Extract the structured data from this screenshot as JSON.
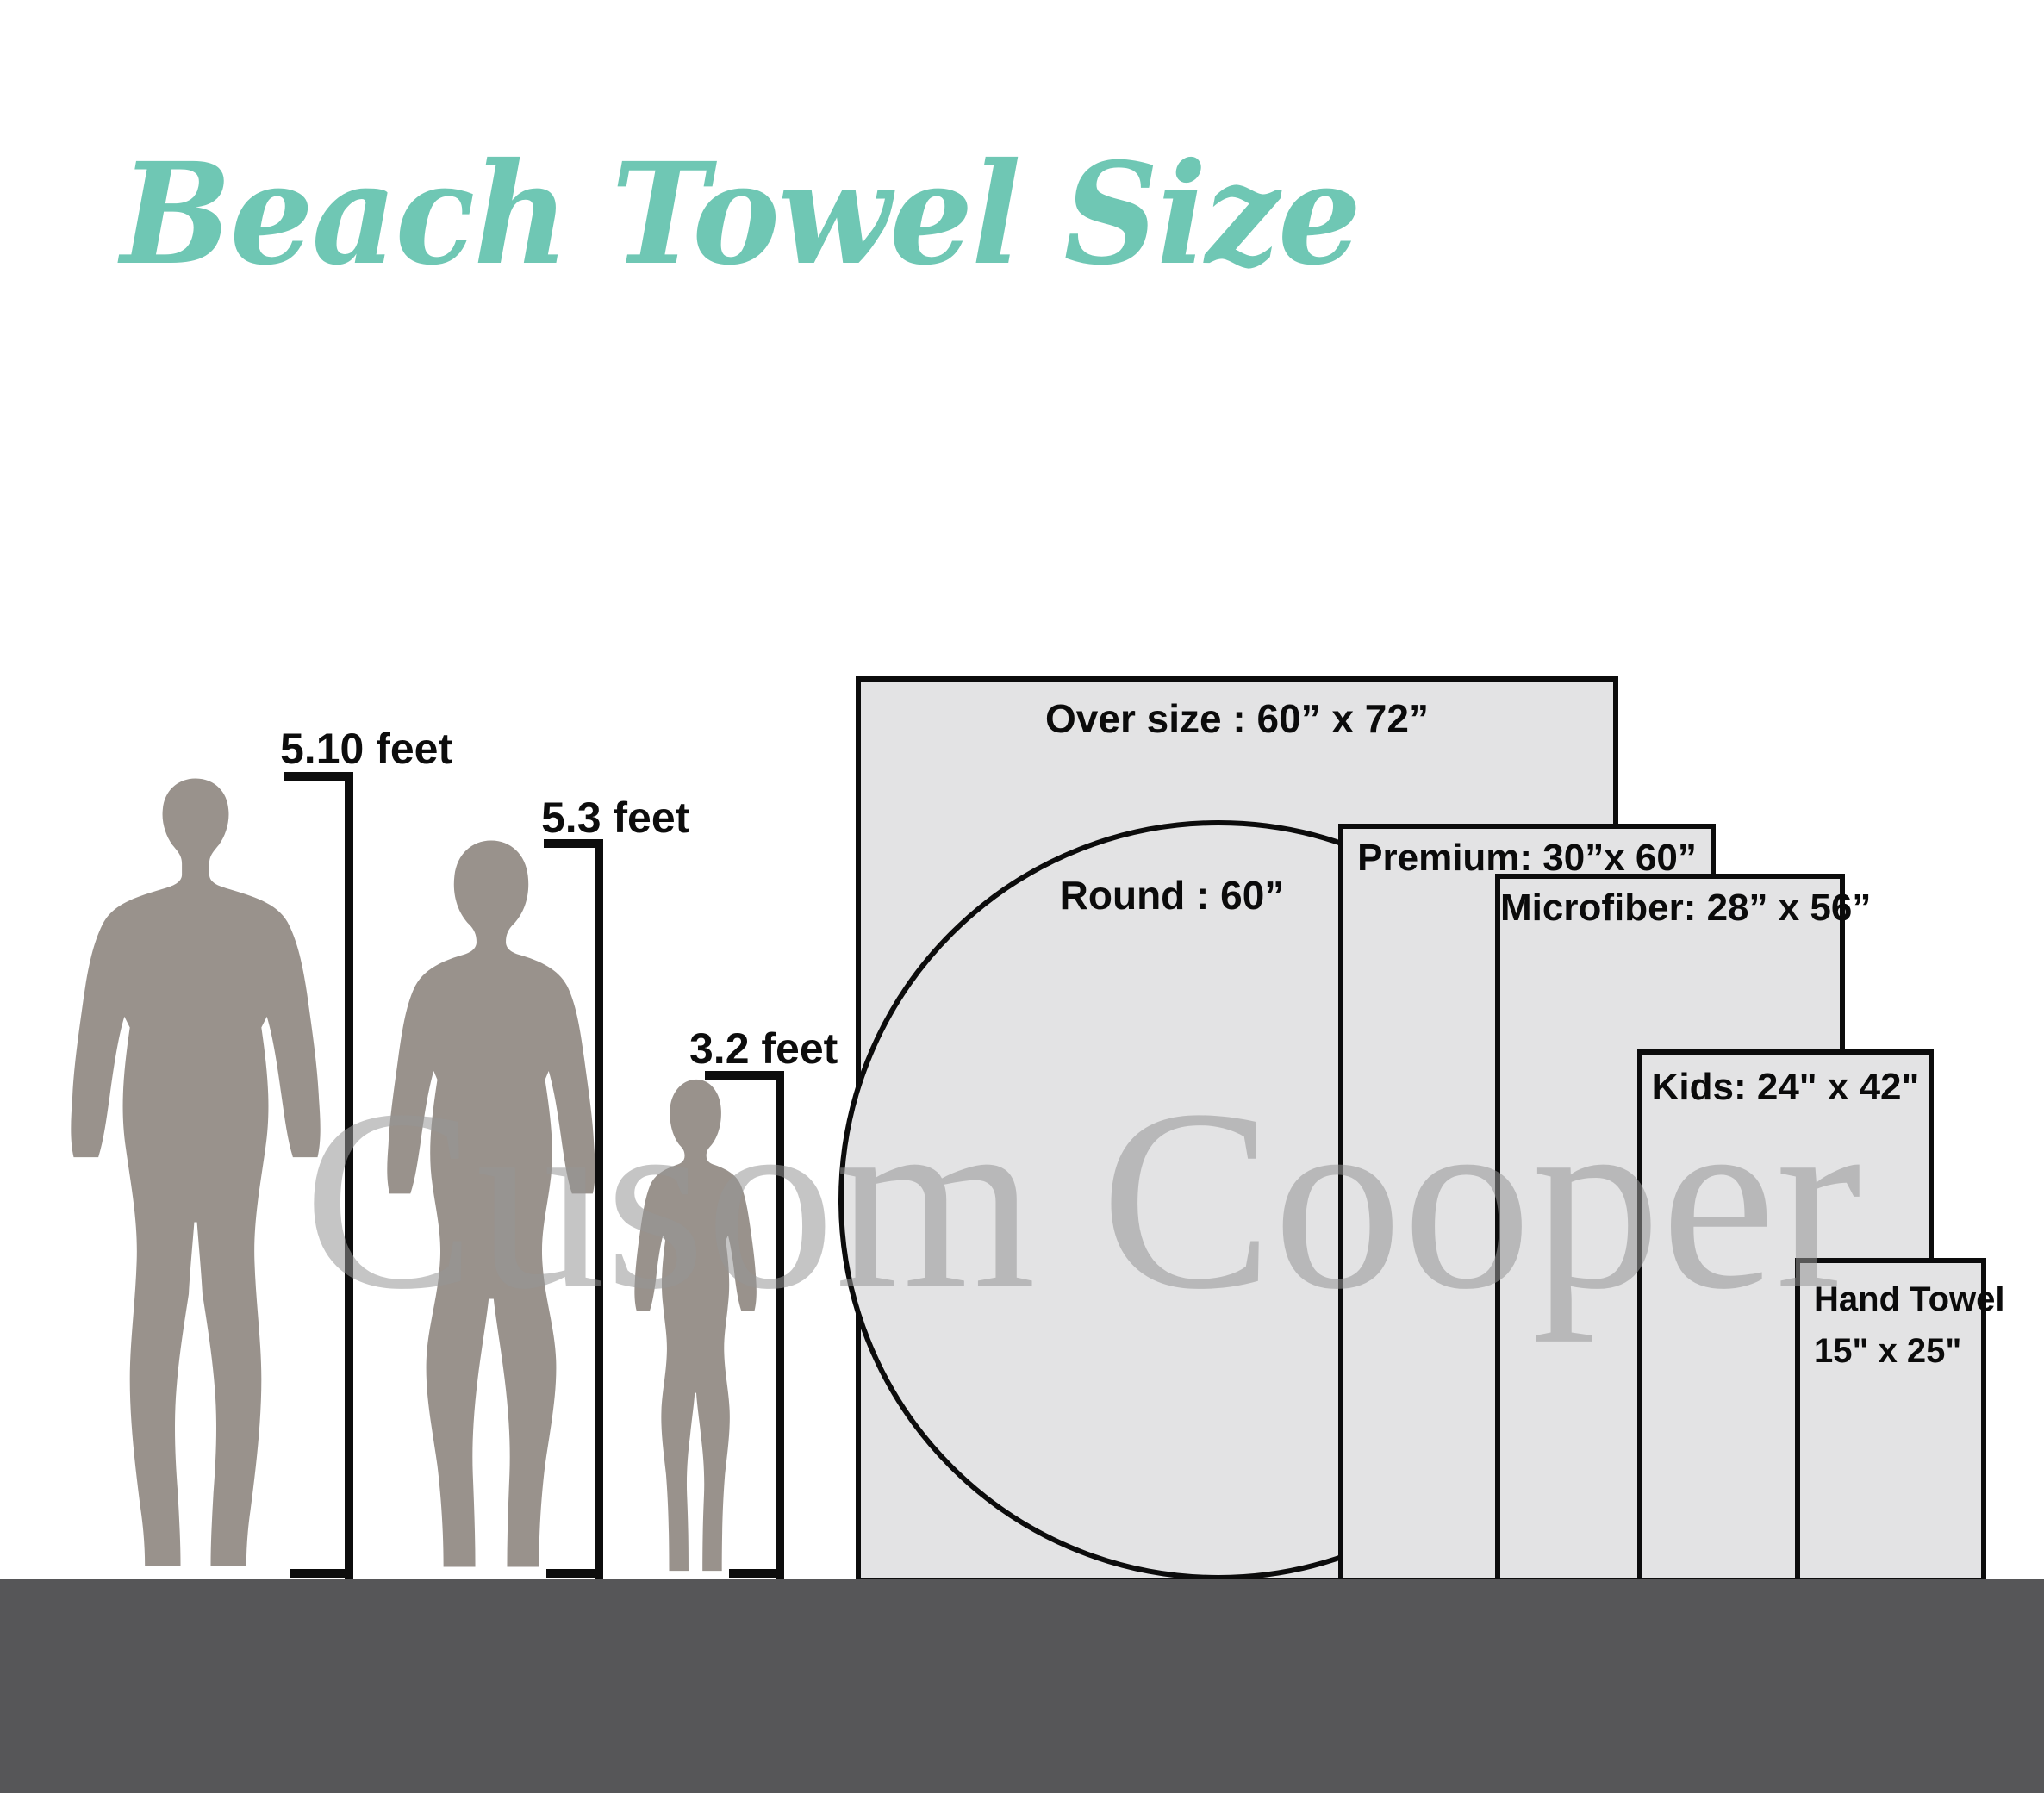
{
  "title": "Beach Towel Size",
  "watermark": "Cusom Cooper",
  "people": [
    {
      "name": "man",
      "height_label": "5.10 feet"
    },
    {
      "name": "woman",
      "height_label": "5.3 feet"
    },
    {
      "name": "child",
      "height_label": "3.2 feet"
    }
  ],
  "towels": [
    {
      "id": "oversize",
      "name": "Over size",
      "dimensions": "60” x 72”",
      "label": "Over size  : 60” x 72”"
    },
    {
      "id": "round",
      "name": "Round",
      "dimensions": "60”",
      "label": "Round  : 60”"
    },
    {
      "id": "premium",
      "name": "Premium",
      "dimensions": "30”x 60”",
      "label": "Premium:  30”x 60”"
    },
    {
      "id": "microfiber",
      "name": "Microfiber",
      "dimensions": "28” x 56”",
      "label": "Microfiber: 28” x 56”"
    },
    {
      "id": "kids",
      "name": "Kids",
      "dimensions": "24\" x 42\"",
      "label": "Kids: 24\" x 42\""
    },
    {
      "id": "hand",
      "name": "Hand Towel",
      "dimensions": "15\" x 25\"",
      "label_line1": "Hand Towel",
      "label_line2": "15\" x 25\""
    }
  ],
  "colors": {
    "accent_teal": "#6fc7b4",
    "towel_fill": "#e3e3e4",
    "outline": "#0c0c0c",
    "ground": "#565658",
    "silhouette": "#99928c",
    "watermark_gray": "#c9c9c9",
    "label_text": "#0d0d0d"
  }
}
